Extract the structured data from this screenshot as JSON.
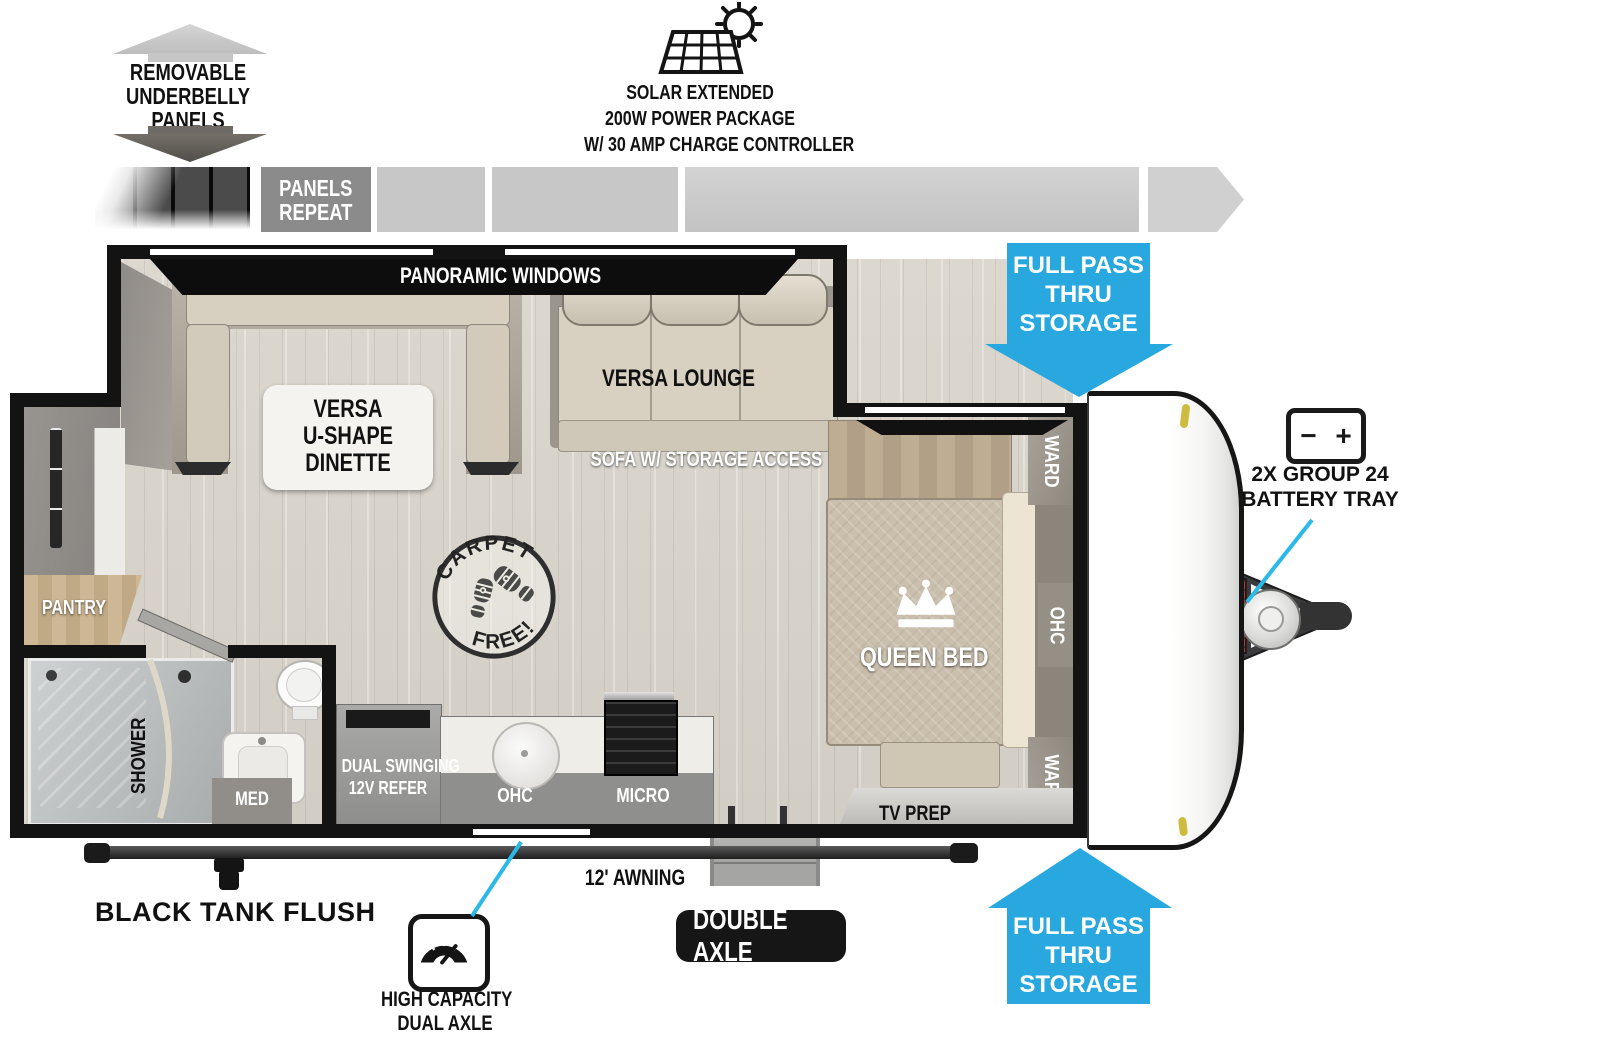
{
  "colors": {
    "accent_blue": "#29a8e0",
    "callout_cyan": "#2bb9e8",
    "wall_black": "#131313",
    "cushion_beige": "#d5cec0",
    "bar_gray": "#c7c7c7",
    "panels_repeat_gray": "#8b8b8b"
  },
  "annotations": {
    "underbelly": {
      "lines": [
        "REMOVABLE",
        "UNDERBELLY",
        "PANELS"
      ]
    },
    "solar": {
      "lines": [
        "SOLAR EXTENDED",
        "200W POWER PACKAGE",
        "W/ 30 AMP CHARGE CONTROLLER"
      ]
    },
    "panels_repeat": {
      "lines": [
        "PANELS",
        "REPEAT"
      ]
    },
    "pass_thru_top": {
      "lines": [
        "FULL PASS",
        "THRU",
        "STORAGE"
      ]
    },
    "pass_thru_bottom": {
      "lines": [
        "FULL PASS",
        "THRU",
        "STORAGE"
      ]
    },
    "battery": {
      "minus": "−",
      "plus": "+",
      "lines": [
        "2X GROUP 24",
        "BATTERY TRAY"
      ]
    },
    "black_tank_flush": "BLACK TANK FLUSH",
    "awning": "12' AWNING",
    "double_axle": "DOUBLE AXLE",
    "high_capacity": {
      "lines": [
        "HIGH CAPACITY",
        "DUAL AXLE"
      ]
    },
    "carpet_free": {
      "top": "CARPET",
      "bottom": "FREE!"
    }
  },
  "rooms": {
    "panoramic_windows": "PANORAMIC WINDOWS",
    "dinette": {
      "lines": [
        "VERSA",
        "U-SHAPE",
        "DINETTE"
      ]
    },
    "lounge": "VERSA LOUNGE",
    "sofa": "SOFA W/ STORAGE ACCESS",
    "queen_bed": "QUEEN BED",
    "ward_top": "WARD",
    "ohc_bedroom": "OHC",
    "ward_bottom": "WARD",
    "tv_prep": "TV PREP",
    "pantry": "PANTRY",
    "shower": "SHOWER",
    "med": "MED",
    "refer": {
      "lines": [
        "DUAL SWINGING",
        "12V REFER"
      ]
    },
    "ohc_kitchen": "OHC",
    "micro": "MICRO"
  }
}
